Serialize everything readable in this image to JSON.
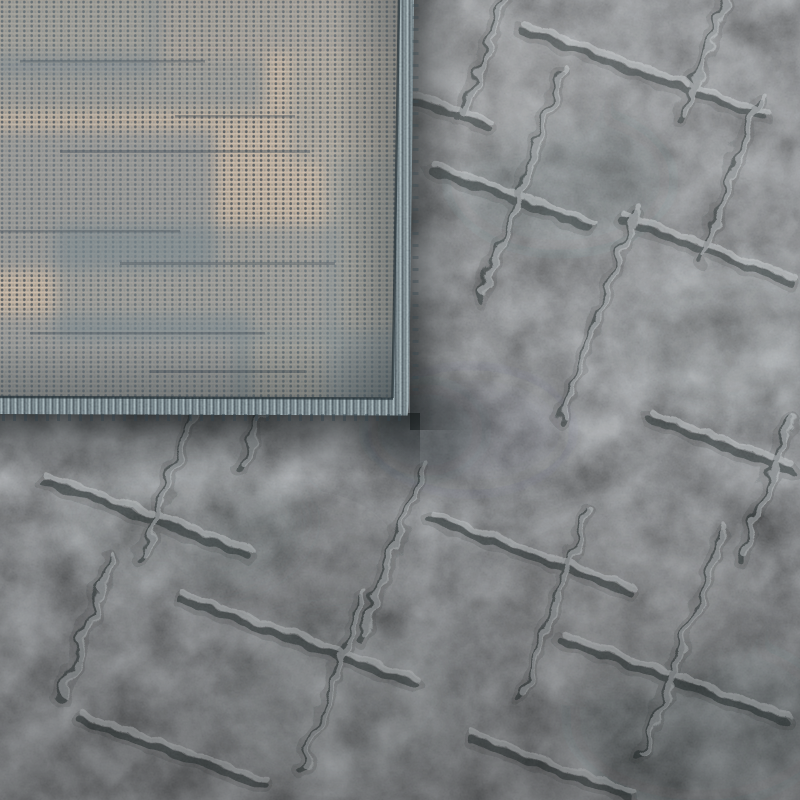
{
  "image": {
    "description": "Close-up product photograph of a dark gray high-low textured rug with its corner folded over, revealing a beige flat-woven backing speckled with dark weave dots and gray wear patches, finished with a slate blue-gray serged binding edge",
    "subject": "rug corner detail photo"
  },
  "colors": {
    "pile_base": "#6e7072",
    "pile_dark": "#22282a",
    "pile_soft_dark": "#30363a",
    "pile_light": "#c6cacb",
    "backing_base": "#bfac96",
    "backing_light": "#d4c3ad",
    "backing_dot": "#3d464b",
    "backing_dot_soft": "#6f7a80",
    "backing_patch": "#74828a",
    "backing_streak": "#48525a",
    "binding_light": "#a6b9be",
    "binding_mid": "#5f727a",
    "binding_dark": "#33434b",
    "binding_faint": "#7e9197",
    "seam": "#212d33",
    "shadow": "#0f1314",
    "vignette": "#000000",
    "highlight": "#ffffff"
  }
}
